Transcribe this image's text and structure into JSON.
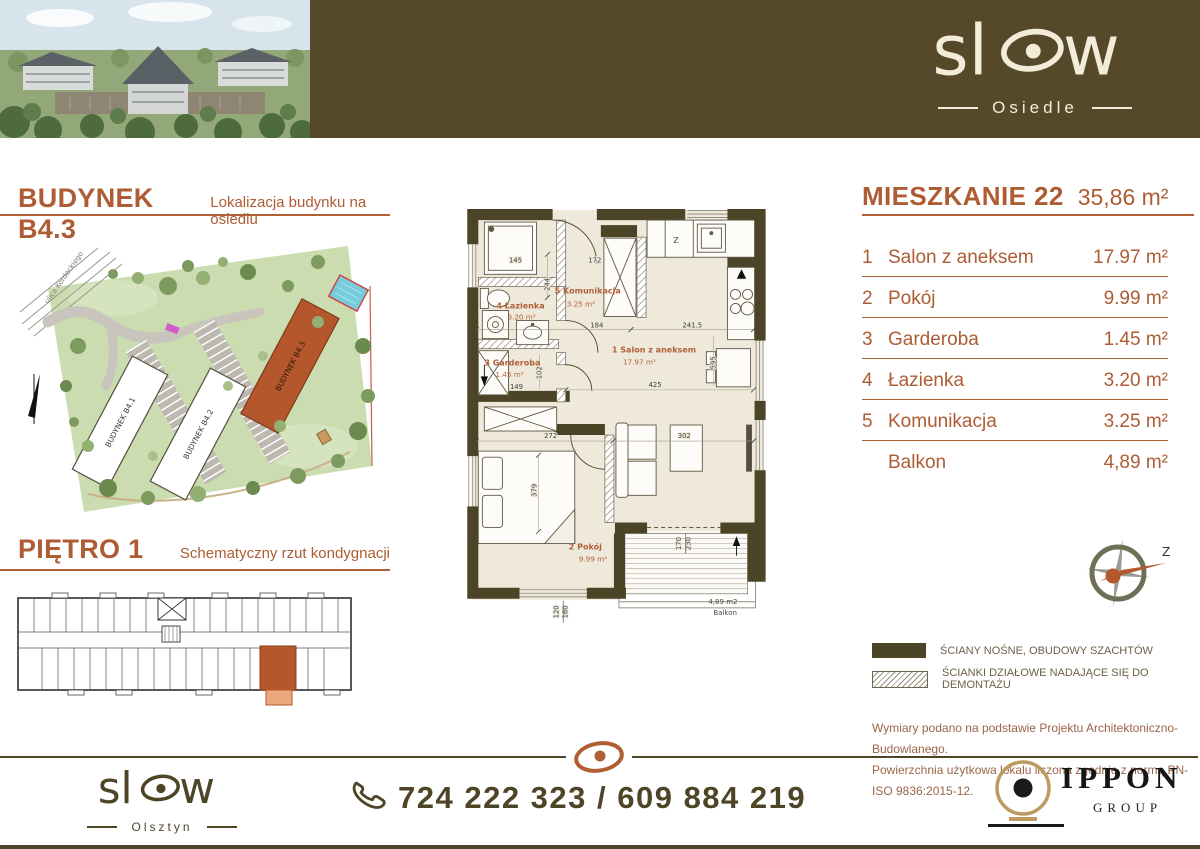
{
  "header": {
    "logo_l": "sl",
    "logo_r": "w",
    "logo_sub": "Osiedle"
  },
  "sections": {
    "building": {
      "title": "BUDYNEK B4.3",
      "subtitle": "Lokalizacja budynku na osiedlu"
    },
    "floor": {
      "title": "PIĘTRO 1",
      "subtitle": "Schematyczny rzut kondygnacji"
    }
  },
  "site_map": {
    "street": "ulica Kordeckiego",
    "building_1": "BUDYNEK B4.1",
    "building_2": "BUDYNEK B4.2",
    "building_3": "BUDYNEK B4.3"
  },
  "apartment": {
    "title": "MIESZKANIE 22",
    "total_area": "35,86 m²",
    "rooms": [
      {
        "no": "1",
        "name": "Salon z aneksem",
        "area": "17.97 m²"
      },
      {
        "no": "2",
        "name": "Pokój",
        "area": "9.99 m²"
      },
      {
        "no": "3",
        "name": "Garderoba",
        "area": "1.45 m²"
      },
      {
        "no": "4",
        "name": "Łazienka",
        "area": "3.20 m²"
      },
      {
        "no": "5",
        "name": "Komunikacja",
        "area": "3.25 m²"
      },
      {
        "no": "",
        "name": "Balkon",
        "area": "4,89 m²"
      }
    ]
  },
  "floorplan": {
    "rooms": {
      "salon": {
        "label": "1 Salon z aneksem",
        "area": "17.97 m²"
      },
      "pokoj": {
        "label": "2 Pokój",
        "area": "9.99 m²"
      },
      "garderoba": {
        "label": "3 Garderoba",
        "area": "1.45 m²"
      },
      "lazienka": {
        "label": "4 Łazienka",
        "area": "3.20 m²"
      },
      "komunikacja": {
        "label": "5 Komunikacja",
        "area": "3.25 m²"
      }
    },
    "balcony": {
      "area": "4,89 m2",
      "label": "Balkon"
    },
    "kitchen_label": "Z",
    "dims": {
      "d145": "145",
      "d172": "172",
      "d244": "244",
      "d184": "184",
      "d241_5": "241.5",
      "d102": "102",
      "d149": "149",
      "d425": "425",
      "d272": "272",
      "d302": "302",
      "d379": "379",
      "d595": "595",
      "d120": "120",
      "d160": "160",
      "d170": "170",
      "d230": "230"
    }
  },
  "compass": {
    "label": "Z"
  },
  "legend": {
    "solid_label": "ŚCIANY NOŚNE, OBUDOWY SZACHTÓW",
    "hatched_label": "ŚCIANKI DZIAŁOWE NADAJĄCE SIĘ DO DEMONTAŻU"
  },
  "notes": {
    "line1": "Wymiary podano na podstawie Projektu Architektoniczno-Budowlanego.",
    "line2": "Powierzchnia użytkowa lokalu liczona zgodnie z normą PN-ISO 9836:2015-12."
  },
  "footer": {
    "logo_l": "sl",
    "logo_r": "w",
    "logo_sub": "Olsztyn",
    "phone": "724 222 323 / 609 884 219",
    "partner_name": "IPPON",
    "partner_sub": "GROUP"
  },
  "colors": {
    "olive": "#56492a",
    "rust": "#b05f33",
    "wall": "#4c4426",
    "floor": "#efe9dc",
    "gold": "#bd9a5f",
    "highlight": "#b4572c"
  }
}
